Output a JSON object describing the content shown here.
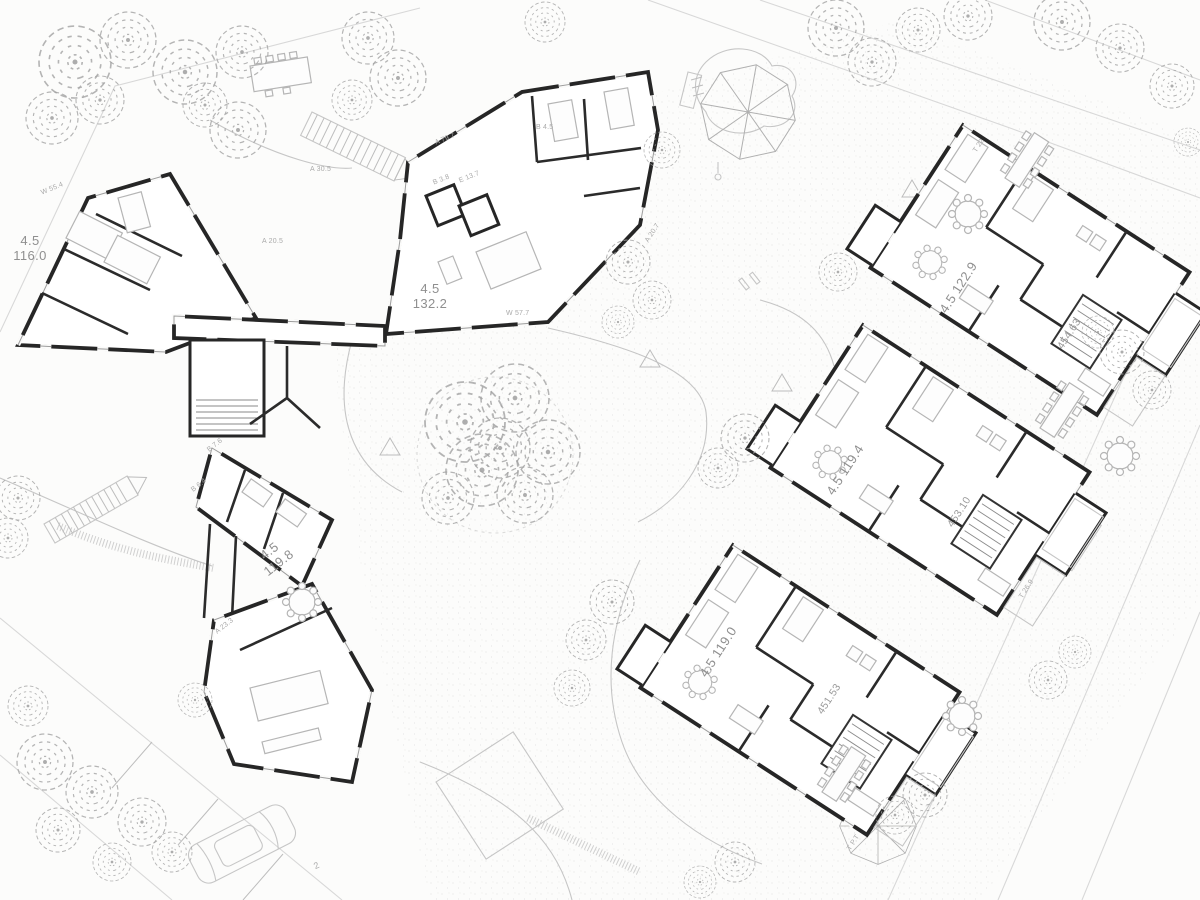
{
  "plan": {
    "labels": [
      {
        "text": "4.5\n116.0"
      },
      {
        "text": "4.5\n132.2"
      },
      {
        "text": "4.5\n119.8"
      },
      {
        "text": "4.5 122.9"
      },
      {
        "text": "454.63"
      },
      {
        "text": "4.5 119.4"
      },
      {
        "text": "453.10"
      },
      {
        "text": "4.5 119.0"
      },
      {
        "text": "451.53"
      }
    ],
    "small_labels": [
      {
        "text": "A 79.7"
      },
      {
        "text": "B 4.5"
      },
      {
        "text": "B 3.8"
      },
      {
        "text": "E 13.7"
      },
      {
        "text": "W 55.4"
      },
      {
        "text": "A 30.5"
      },
      {
        "text": "A 20.5"
      },
      {
        "text": "W 57.7"
      },
      {
        "text": "A 20.7"
      },
      {
        "text": "B 7.6"
      },
      {
        "text": "B 6.4"
      },
      {
        "text": "A 23.3"
      },
      {
        "text": "T 22"
      },
      {
        "text": "T 26.9"
      },
      {
        "text": "T P.T"
      },
      {
        "text": "2"
      }
    ],
    "colors": {
      "background": "#fcfcfb",
      "wall": "#262626",
      "furniture": "#b5b5b5",
      "label": "#8f8f8f",
      "vegetation": "#a3a3a3"
    }
  }
}
